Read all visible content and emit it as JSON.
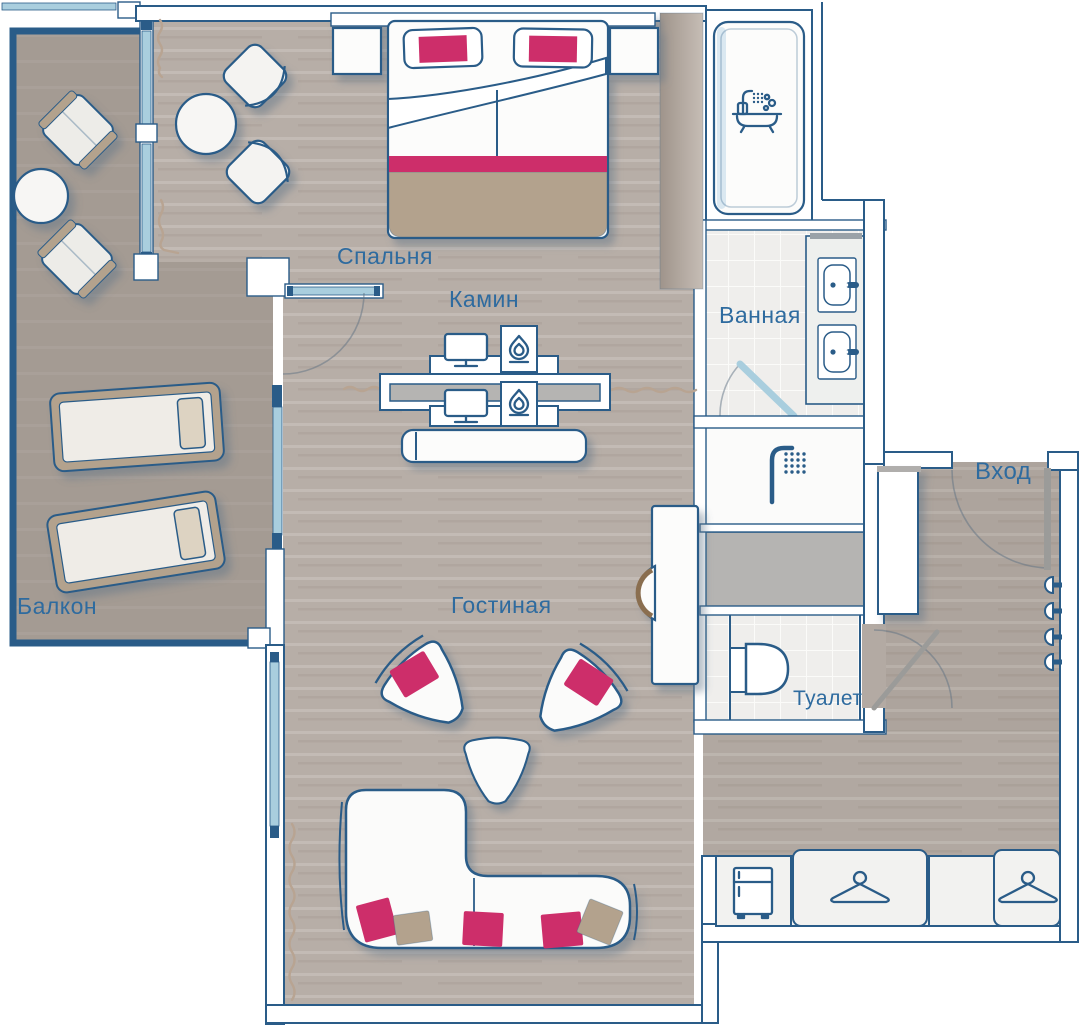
{
  "rooms": {
    "bedroom": {
      "label": "Спальня"
    },
    "fireplace": {
      "label": "Камин"
    },
    "bathroom": {
      "label": "Ванная"
    },
    "entrance": {
      "label": "Вход"
    },
    "living_room": {
      "label": "Гостиная"
    },
    "toilet": {
      "label": "Туалет"
    },
    "balcony": {
      "label": "Балкон"
    }
  },
  "watermark": {
    "brand": "ClubMed",
    "symbol": "Ψ",
    "text": "на Вернадского · actravel.ru"
  },
  "colors": {
    "outline": "#2a5c88",
    "window": "#a9cede",
    "label": "#2e6b9f",
    "floor": "#b7aea7",
    "balcony": "#a49b93",
    "tile": "#efeeec",
    "accent": "#cd2f6a",
    "tan": "#b3a28d",
    "gray": "#b5b4b2",
    "watermark": "#8294a8"
  },
  "icons": [
    "bathtub-icon",
    "shower-icon",
    "flame-icon",
    "tv-icon",
    "hanger-icon",
    "fridge-icon",
    "coat-hook-icon",
    "sink-icon",
    "toilet-icon"
  ]
}
